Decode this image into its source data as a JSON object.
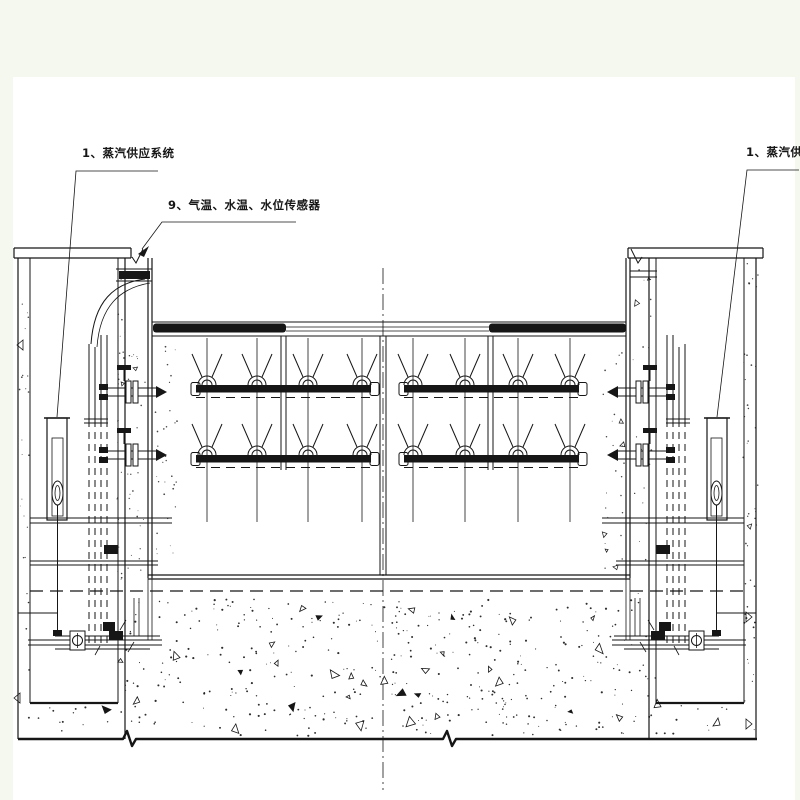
{
  "drawing": {
    "background_color": "#f4f8ee",
    "paper_color": "#ffffff",
    "ink_color": "#161616",
    "callouts": {
      "steam_left": {
        "label": "1、蒸汽供应系统"
      },
      "sensors": {
        "label": "9、气温、水温、水位传感器"
      },
      "steam_right": {
        "label": "1、蒸汽供应系统"
      }
    }
  }
}
